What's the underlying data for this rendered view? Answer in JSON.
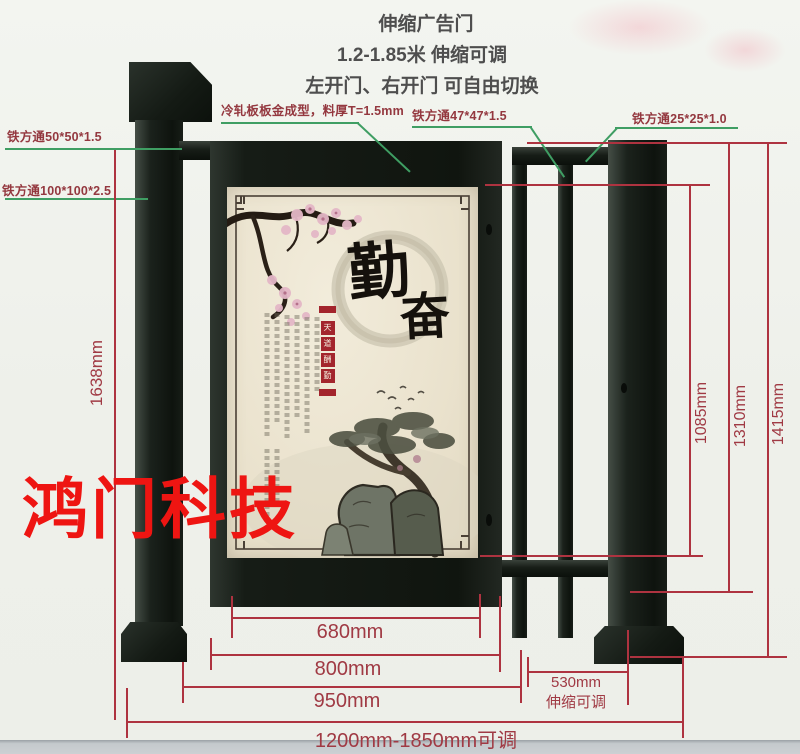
{
  "header": {
    "line1": "伸缩广告门",
    "line2": "1.2-1.85米 伸缩可调",
    "line3": "左开门、右开门 可自由切换"
  },
  "callouts": {
    "tube50": "铁方通50*50*1.5",
    "tube100": "铁方通100*100*2.5",
    "cold_rolled": "冷轧板板金成型，料厚T=1.5mm",
    "tube47": "铁方通47*47*1.5",
    "tube25": "铁方通25*25*1.0"
  },
  "dimensions": {
    "left_total_height": "1638mm",
    "inner_height": "1085mm",
    "frame_height": "1310mm",
    "post_height": "1415mm",
    "panel_width": "680mm",
    "door_width": "800mm",
    "leaf_width": "950mm",
    "retract_width": "530mm",
    "retract_note": "伸缩可调",
    "total_width_range": "1200mm-1850mm可调"
  },
  "watermark": "鸿门科技",
  "poster": {
    "calligraphy_char_1": "勤",
    "calligraphy_char_2": "奋",
    "seal_banner": "天道酬勤",
    "seal_chars": [
      "天",
      "道",
      "酬",
      "勤"
    ]
  },
  "colors": {
    "dimension_red": "#ae3340",
    "label_maroon": "#94383f",
    "leader_green": "#3f9e63",
    "watermark_red": "#ee1512",
    "metal_dark": "#1b221c",
    "poster_cream": "#ece5d2"
  }
}
